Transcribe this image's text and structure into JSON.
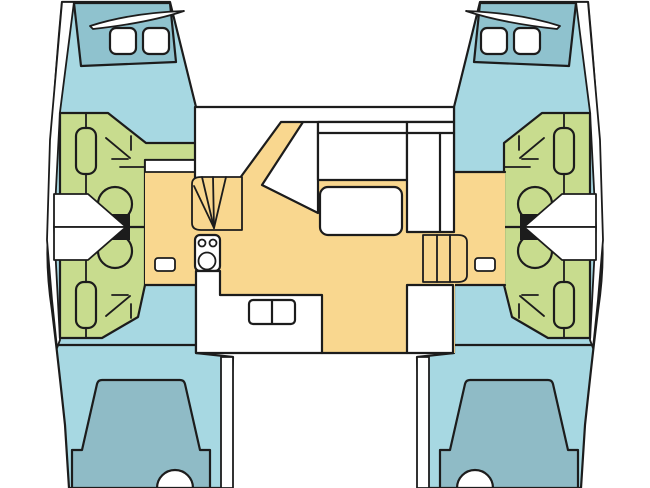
{
  "diagram": {
    "type": "yacht-deck-floor-plan",
    "vessel": "catamaran",
    "view": "top-down",
    "layout": "4 cabins, 4 heads, central saloon with galley"
  },
  "colors": {
    "hull": "#A7D8E2",
    "foredeck": "#8FC2CE",
    "berth": "#8FBBC6",
    "heads": "#C8DC8E",
    "floor": "#F9D78F",
    "white": "#FFFFFF",
    "tank": "#1C1C1C",
    "outline": "#1C1C1C",
    "background": "#FFFFFF"
  },
  "symbols": {
    "toilet": "circle with black cistern block",
    "washbasin": "rounded vertical rectangle",
    "shower": "diagonal arrow with corner ticks",
    "stove": "rounded rectangle with two small and one large burner",
    "stairs": "parallel tread lines",
    "curved-stairs": "radiating wedge treads",
    "berth": "rounded trapezoid with foot notch",
    "hatch": "rounded white square"
  }
}
